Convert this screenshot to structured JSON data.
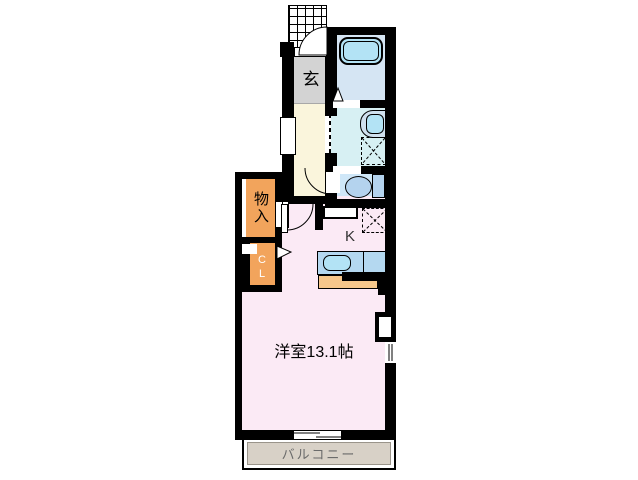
{
  "plan": {
    "rooms": {
      "genkan": {
        "label": "玄"
      },
      "storage": {
        "label": "物入"
      },
      "closet": {
        "label": "CL"
      },
      "kitchen": {
        "label": "K"
      },
      "western_room": {
        "label": "洋室13.1帖",
        "size_jo": 13.1
      },
      "balcony": {
        "label": "バルコニー"
      }
    },
    "colors": {
      "wall": "#000000",
      "genkan_floor": "#d3d3d3",
      "hallway_floor": "#faf5dc",
      "bathroom_floor": "#d5e5f3",
      "bathtub": "#b3e3f5",
      "washroom_floor": "#d7f0f3",
      "toilet_floor": "#cfe7f8",
      "fixture_blue": "#b4d3ee",
      "storage_orange": "#f2a45c",
      "main_room_pink": "#fbeaf5",
      "kitchen_counter": "#b4d8f0",
      "counter_base_orange": "#f6c78b",
      "balcony_gray": "#d8d1c7",
      "balcony_text": "#6b6b6b"
    }
  }
}
